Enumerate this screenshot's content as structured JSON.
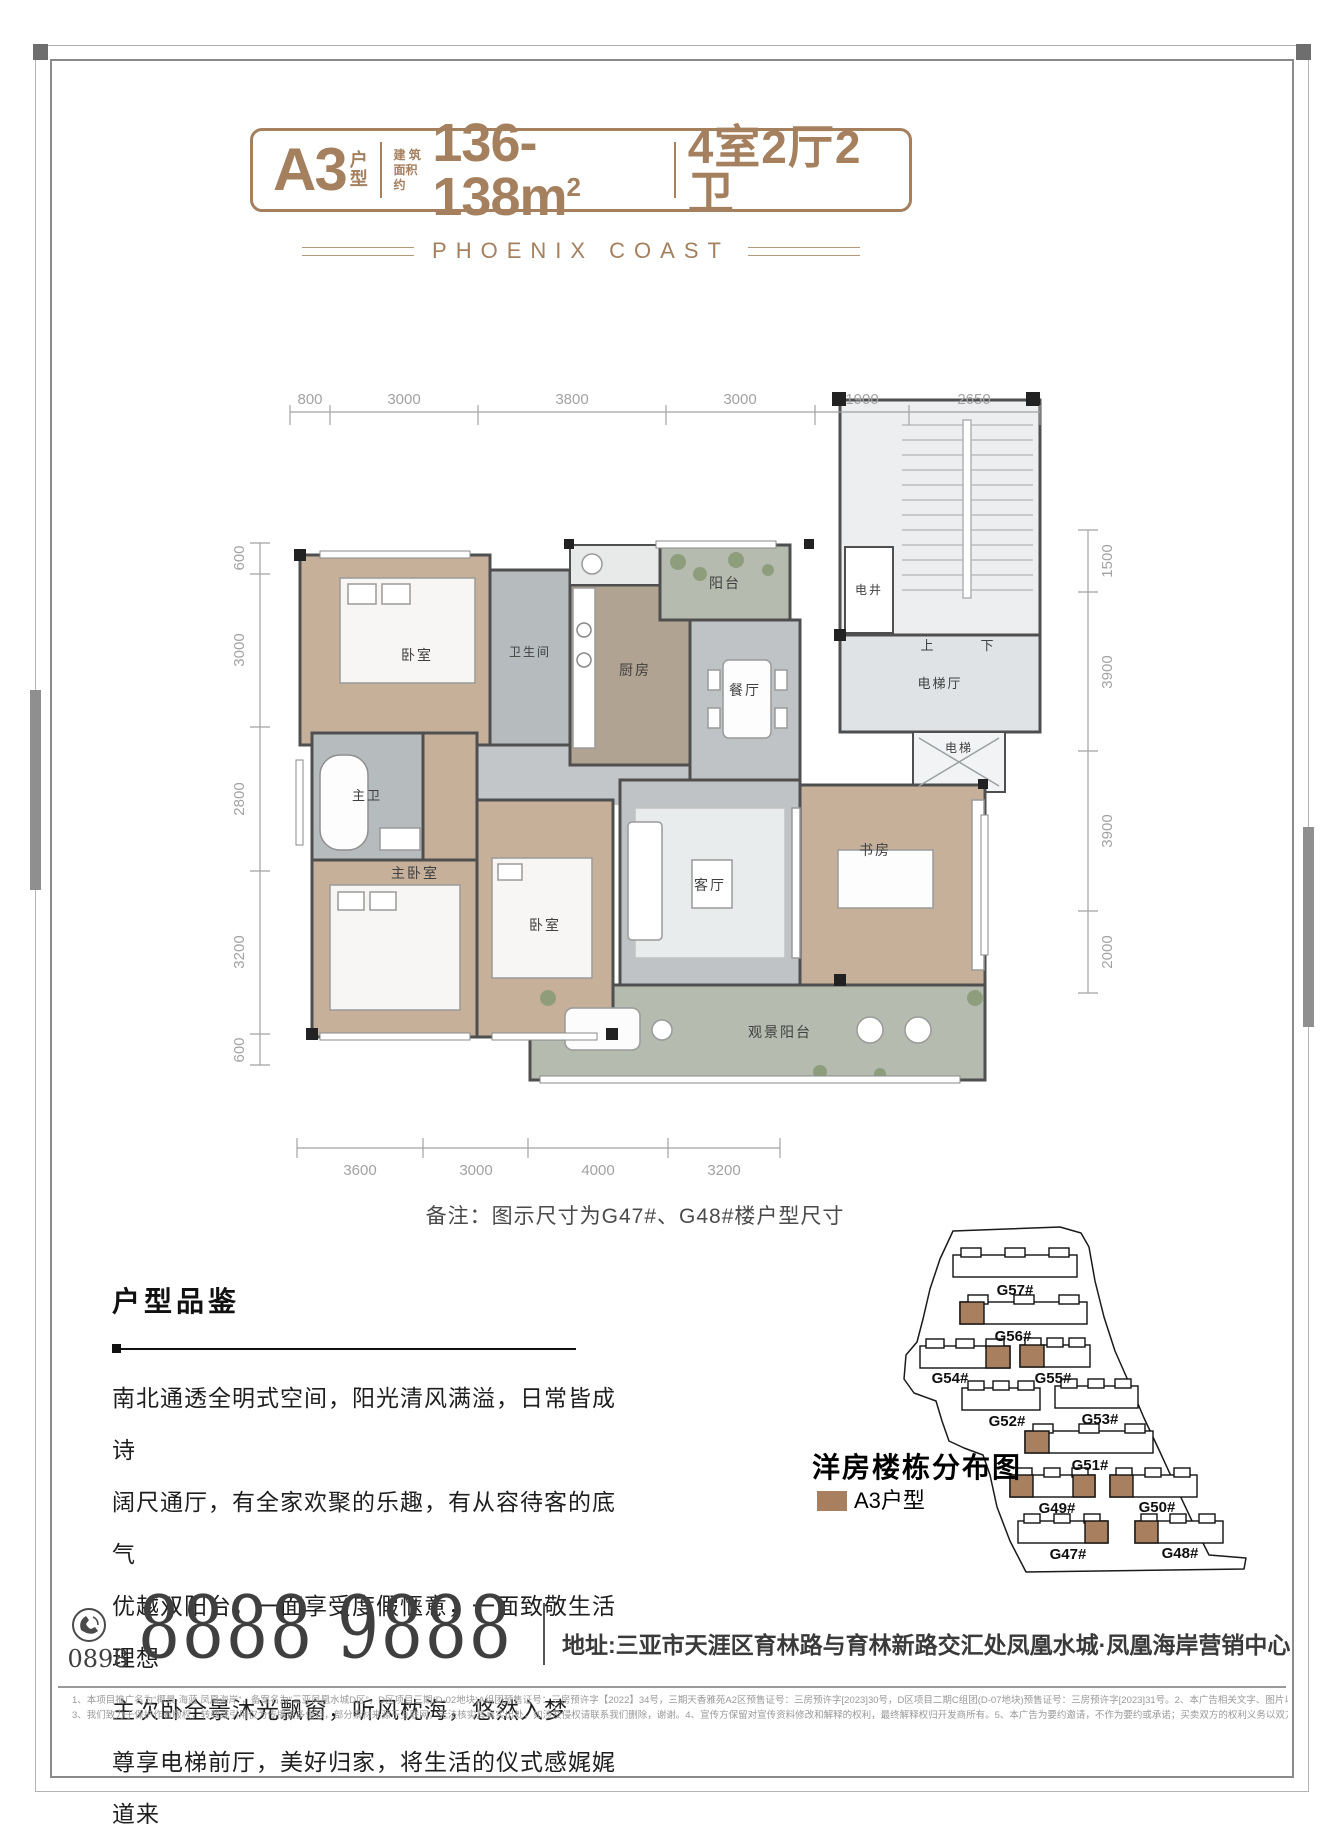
{
  "header": {
    "unit": "A3",
    "unit_suffix_top": "户",
    "unit_suffix_bottom": "型",
    "area_label_line1": "建 筑",
    "area_label_line2": "面积约",
    "area_value": "136-138m",
    "area_sup": "2",
    "rooms": "4室2厅2卫",
    "brand": "PHOENIX COAST",
    "accent_color": "#a5805f"
  },
  "floor_plan": {
    "note": "备注：图示尺寸为G47#、G48#楼户型尺寸",
    "dims": {
      "top": [
        "800",
        "3000",
        "3800",
        "3000",
        "1900",
        "2650"
      ],
      "bottom": [
        "3600",
        "3000",
        "4000",
        "3200"
      ],
      "left": [
        "600",
        "3000",
        "2800",
        "3200",
        "600"
      ],
      "right": [
        "1500",
        "3900",
        "3900",
        "2000"
      ]
    },
    "rooms": {
      "bedroom_top": "卧室",
      "bath": "卫生间",
      "kitchen": "厨房",
      "balcony_top": "阳台",
      "dining": "餐厅",
      "shaft": "电井",
      "stair_up": "上",
      "stair_down": "下",
      "elevator_hall": "电梯厅",
      "elevator": "电梯",
      "master_bath": "主卫",
      "master_bedroom": "主卧室",
      "bedroom2": "卧室",
      "living": "客厅",
      "study": "书房",
      "view_balcony": "观景阳台"
    }
  },
  "description": {
    "title": "户型品鉴",
    "lines": [
      "南北通透全明式空间，阳光清风满溢，日常皆成诗",
      "阔尺通厅，有全家欢聚的乐趣，有从容待客的底气",
      "优越双阳台，一面享受度假惬意，一面致敬生活理想",
      "主次卧全景沐光飘窗，听风枕海，悠然入梦",
      "尊享电梯前厅，美好归家，将生活的仪式感娓娓道来"
    ]
  },
  "site_map": {
    "title": "洋房楼栋分布图",
    "legend_label": "A3户型",
    "highlight_color": "#a9805f",
    "buildings": [
      "G57#",
      "G56#",
      "G54#",
      "G55#",
      "G52#",
      "G53#",
      "G51#",
      "G49#",
      "G50#",
      "G47#",
      "G48#"
    ]
  },
  "footer": {
    "area_code": "0898",
    "phone": "8888 9888",
    "address": "地址:三亚市天涯区育林路与育林新路交汇处凤凰水城·凤凰海岸营销中心",
    "disclaimer_line1": "1、本项目推广名为“椰景·海蓝 凤凰海岸”，备案名为“三亚凤凰水城D区”，D区项目三期(D-02地块)A组团预售证号：三房预许字【2022】34号，三期天香雅苑A2区预售证号：三房预许字[2023]30号，D区项目二期C组团(D-07地块)预售证号：三房预许字[2023]31号。2、本广告相关文字、图片以及建筑设计效果图皆对项目所做的示意表达，仅供参考，最终以政府相关部门批准的文件、图则为准。",
    "disclaimer_line2": "3、我们致力于保护作者版权，转载或引用仅为传播更多信息，部分素材来源于互联网，无法核实其真实出处，如涉及侵权请联系我们删除，谢谢。4、宣传方保留对宣传资料修改和解释的权利，最终解释权归开发商所有。5、本广告为要约邀请，不作为要约或承诺；买卖双方的权利义务以双方签订的《商品房买卖合同》等书面文件为准，在法律的范围内本广告最终解释权归开发商所有。"
  }
}
